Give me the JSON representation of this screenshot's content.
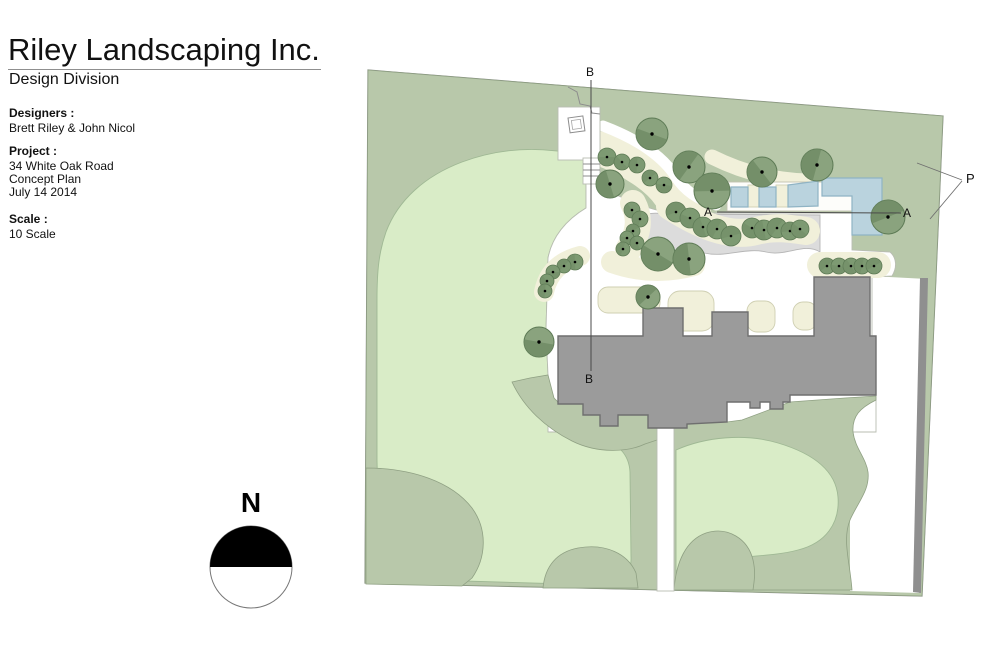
{
  "header": {
    "company": "Riley Landscaping Inc.",
    "division": "Design Division"
  },
  "info": {
    "designers_label": "Designers :",
    "designers": "Brett Riley & John Nicol",
    "project_label": "Project :",
    "project_line1": "34 White Oak Road",
    "project_line2": "Concept Plan",
    "project_line3": "July 14  2014",
    "scale_label": "Scale :",
    "scale": "10 Scale"
  },
  "compass": {
    "label": "N"
  },
  "plan": {
    "section_labels": {
      "b_top": "B",
      "b_bottom": "B",
      "a_left": "A",
      "a_right": "A",
      "p": "P"
    },
    "colors": {
      "sage": "#b8c8aa",
      "lawn": "#d9ecc7",
      "cream": "#f1f0da",
      "path_gray": "#dcdcdc",
      "building": "#9b9b9b",
      "road": "#8f8f8f",
      "pool": "#bad3de",
      "pool_stroke": "#8fb3c4",
      "tree": "#8aa37e",
      "tree_dark": "#6e8a64",
      "tree_outline": "#5d7a55",
      "shrub": "#7d9a72"
    },
    "trees": [
      {
        "x": 652,
        "y": 134,
        "r": 16
      },
      {
        "x": 610,
        "y": 184,
        "r": 14
      },
      {
        "x": 689,
        "y": 167,
        "r": 16
      },
      {
        "x": 712,
        "y": 191,
        "r": 18
      },
      {
        "x": 762,
        "y": 172,
        "r": 15
      },
      {
        "x": 817,
        "y": 165,
        "r": 16
      },
      {
        "x": 888,
        "y": 217,
        "r": 17
      },
      {
        "x": 658,
        "y": 254,
        "r": 17
      },
      {
        "x": 689,
        "y": 259,
        "r": 16
      },
      {
        "x": 648,
        "y": 297,
        "r": 12
      },
      {
        "x": 539,
        "y": 342,
        "r": 15
      }
    ],
    "shrubs": [
      {
        "x": 607,
        "y": 157,
        "r": 9
      },
      {
        "x": 622,
        "y": 162,
        "r": 8
      },
      {
        "x": 637,
        "y": 165,
        "r": 8
      },
      {
        "x": 650,
        "y": 178,
        "r": 8
      },
      {
        "x": 664,
        "y": 185,
        "r": 8
      },
      {
        "x": 632,
        "y": 210,
        "r": 8
      },
      {
        "x": 640,
        "y": 219,
        "r": 8
      },
      {
        "x": 633,
        "y": 231,
        "r": 7
      },
      {
        "x": 627,
        "y": 238,
        "r": 7
      },
      {
        "x": 637,
        "y": 243,
        "r": 7
      },
      {
        "x": 623,
        "y": 249,
        "r": 7
      },
      {
        "x": 676,
        "y": 212,
        "r": 10
      },
      {
        "x": 690,
        "y": 218,
        "r": 10
      },
      {
        "x": 703,
        "y": 227,
        "r": 10
      },
      {
        "x": 717,
        "y": 229,
        "r": 10
      },
      {
        "x": 731,
        "y": 236,
        "r": 10
      },
      {
        "x": 752,
        "y": 228,
        "r": 10
      },
      {
        "x": 764,
        "y": 230,
        "r": 10
      },
      {
        "x": 777,
        "y": 228,
        "r": 10
      },
      {
        "x": 790,
        "y": 231,
        "r": 9
      },
      {
        "x": 800,
        "y": 229,
        "r": 9
      },
      {
        "x": 575,
        "y": 262,
        "r": 8
      },
      {
        "x": 564,
        "y": 266,
        "r": 7
      },
      {
        "x": 553,
        "y": 272,
        "r": 7
      },
      {
        "x": 547,
        "y": 281,
        "r": 7
      },
      {
        "x": 545,
        "y": 291,
        "r": 7
      },
      {
        "x": 827,
        "y": 266,
        "r": 8
      },
      {
        "x": 839,
        "y": 266,
        "r": 8
      },
      {
        "x": 851,
        "y": 266,
        "r": 8
      },
      {
        "x": 862,
        "y": 266,
        "r": 8
      },
      {
        "x": 874,
        "y": 266,
        "r": 8
      }
    ]
  }
}
